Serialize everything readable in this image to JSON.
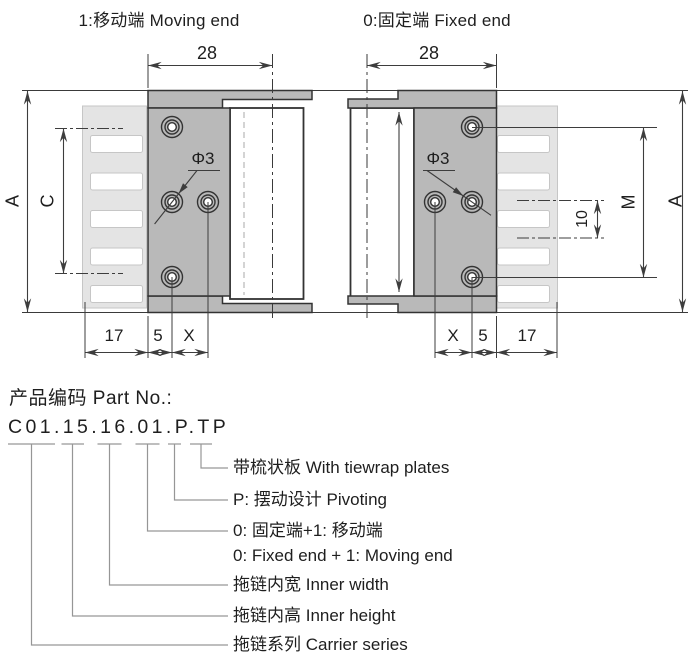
{
  "top_labels": {
    "moving_end": "1:移动端 Moving end",
    "fixed_end": "0:固定端 Fixed end"
  },
  "dimensions": {
    "width_left": "28",
    "width_right": "28",
    "overall_height_left": "A",
    "hole_span_left": "C",
    "hole_span_right": "M",
    "overall_height_right": "A",
    "tooth_pitch": "10",
    "hole_dia_left": "Φ3",
    "hole_dia_right": "Φ3",
    "bottom_left": [
      "17",
      "5",
      "X"
    ],
    "bottom_right": [
      "X",
      "5",
      "17"
    ]
  },
  "part_no": {
    "heading": "产品编码 Part No.:",
    "code": "C01.15.16.01.P.TP",
    "items": [
      {
        "label": "带梳状板 With tiewrap plates"
      },
      {
        "label": "P: 摆动设计 Pivoting"
      },
      {
        "label": "0: 固定端+1: 移动端",
        "label2": "0: Fixed end + 1: Moving end"
      },
      {
        "label": "拖链内宽 Inner width"
      },
      {
        "label": "拖链内高 Inner height"
      },
      {
        "label": "拖链系列 Carrier series"
      }
    ]
  },
  "colors": {
    "bracket_fill": "#b9b9b9",
    "comb_fill": "#e4e4e4",
    "line": "#3a3a3a",
    "connector_gray": "#969696",
    "background": "#ffffff"
  }
}
